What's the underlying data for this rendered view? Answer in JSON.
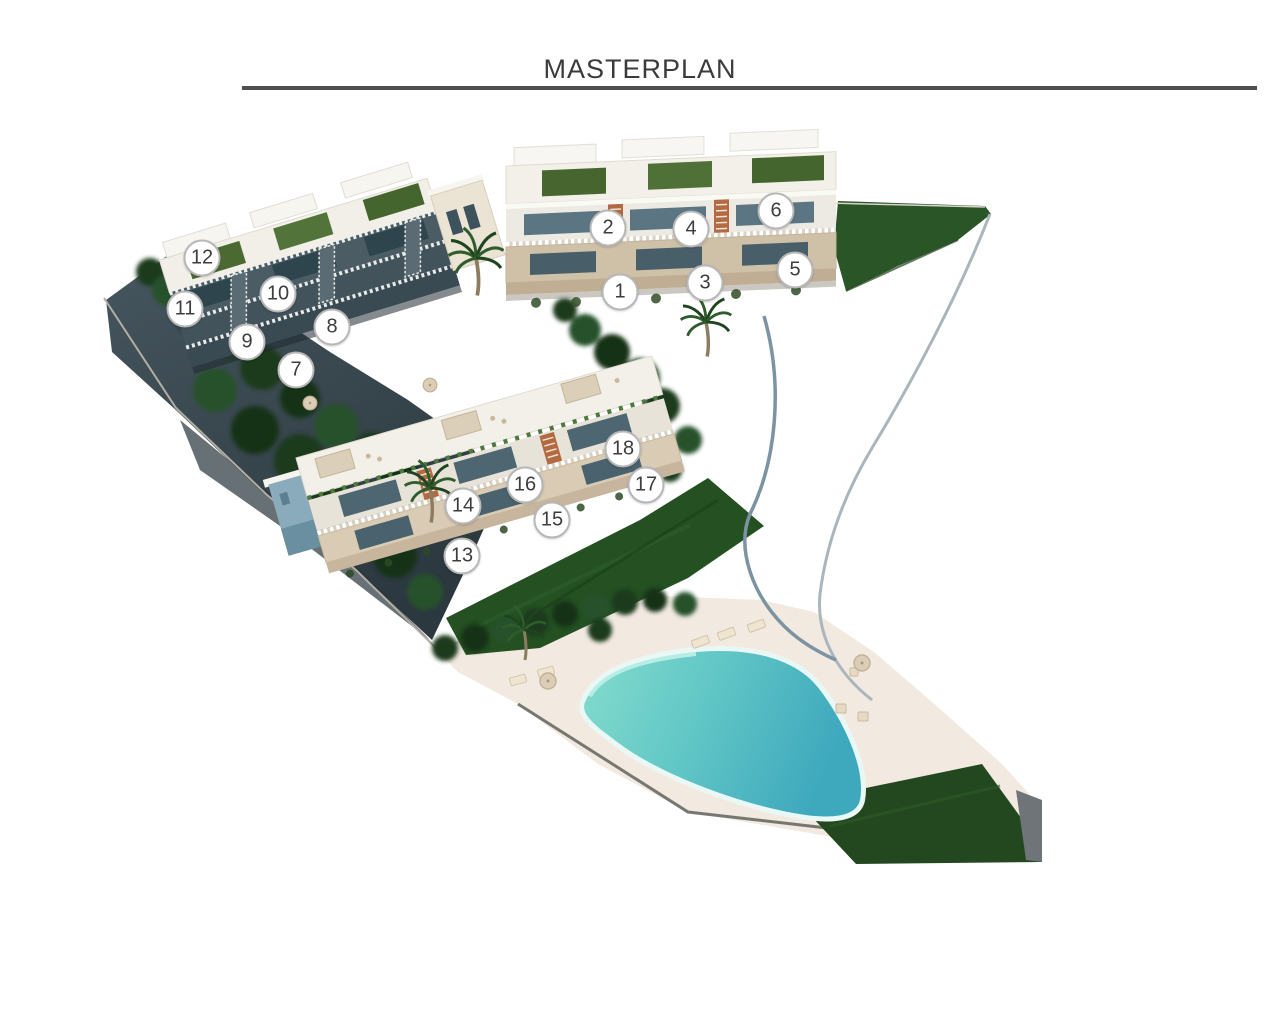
{
  "header": {
    "title": "MASTERPLAN"
  },
  "plan": {
    "caption": "Aerial 3D masterplan render of a terraced residential development with 18 numbered units, gardens, palm trees, an access road and a communal swimming pool",
    "units": [
      {
        "label": "1"
      },
      {
        "label": "2"
      },
      {
        "label": "3"
      },
      {
        "label": "4"
      },
      {
        "label": "5"
      },
      {
        "label": "6"
      },
      {
        "label": "7"
      },
      {
        "label": "8"
      },
      {
        "label": "9"
      },
      {
        "label": "10"
      },
      {
        "label": "11"
      },
      {
        "label": "12"
      },
      {
        "label": "13"
      },
      {
        "label": "14"
      },
      {
        "label": "15"
      },
      {
        "label": "16"
      },
      {
        "label": "17"
      },
      {
        "label": "18"
      }
    ],
    "palette": {
      "title_text": "#3b3b3b",
      "rule": "#4e4e4e",
      "building_white": "#f3f0ea",
      "stone": "#cfc0a8",
      "terracotta_stairs": "#b26a42",
      "glazing": "#4e6671",
      "green_roof": "#4a6a32",
      "lawn": "#245022",
      "trees": "#1d3b1e",
      "hillside": "#3e4e55",
      "facade_blue": "#8aabbc",
      "deck": "#f2e9e1",
      "pool_light": "#84dccd",
      "pool_dark": "#3ea8bd",
      "road_edge": "#7c93a2",
      "marker_bg": "#ffffff",
      "marker_border": "#b7b7b7",
      "marker_text": "#3d3d3d"
    }
  }
}
